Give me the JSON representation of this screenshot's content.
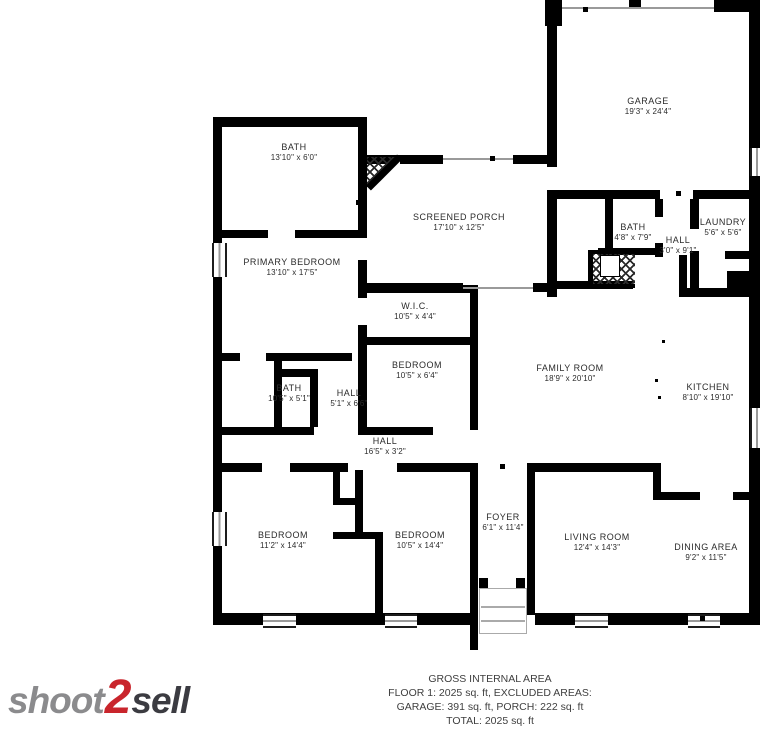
{
  "colors": {
    "wall": "#000000",
    "label_text": "#2b2b2b",
    "logo_red": "#c9252c",
    "logo_gray": "#8b8b8d",
    "logo_dark": "#3b3b41"
  },
  "rooms": [
    {
      "name": "GARAGE",
      "dims": "19'3\" x 24'4\""
    },
    {
      "name": "BATH",
      "dims": "13'10\" x 6'0\""
    },
    {
      "name": "SCREENED PORCH",
      "dims": "17'10\" x 12'5\""
    },
    {
      "name": "BATH",
      "dims": "4'8\" x 7'9\""
    },
    {
      "name": "HALL",
      "dims": "3'0\" x 9'1\""
    },
    {
      "name": "LAUNDRY",
      "dims": "5'6\" x 5'6\""
    },
    {
      "name": "PRIMARY BEDROOM",
      "dims": "13'10\" x 17'5\""
    },
    {
      "name": "W.I.C.",
      "dims": "10'5\" x 4'4\""
    },
    {
      "name": "BEDROOM",
      "dims": "10'5\" x 6'4\""
    },
    {
      "name": "FAMILY ROOM",
      "dims": "18'9\" x 20'10\""
    },
    {
      "name": "KITCHEN",
      "dims": "8'10\" x 19'10\""
    },
    {
      "name": "BATH",
      "dims": "10'5\" x 5'1\""
    },
    {
      "name": "HALL",
      "dims": "5'1\" x 6'6\""
    },
    {
      "name": "HALL",
      "dims": "16'5\" x 3'2\""
    },
    {
      "name": "BEDROOM",
      "dims": "11'2\" x 14'4\""
    },
    {
      "name": "BEDROOM",
      "dims": "10'5\" x 14'4\""
    },
    {
      "name": "FOYER",
      "dims": "6'1\" x 11'4\""
    },
    {
      "name": "LIVING ROOM",
      "dims": "12'4\" x 14'3\""
    },
    {
      "name": "DINING AREA",
      "dims": "9'2\" x 11'5\""
    }
  ],
  "footer": {
    "line1": "GROSS INTERNAL AREA",
    "line2": "FLOOR 1: 2025 sq. ft, EXCLUDED AREAS:",
    "line3": "GARAGE: 391 sq. ft, PORCH: 222 sq. ft",
    "line4": "TOTAL: 2025 sq. ft",
    "disclaimer": "SIZES AND DIMENSIONS ARE APPROXIMATE. ACTUAL MAY VARY."
  },
  "logo": {
    "shoot": "shoot",
    "two": "2",
    "sell": "sell"
  }
}
